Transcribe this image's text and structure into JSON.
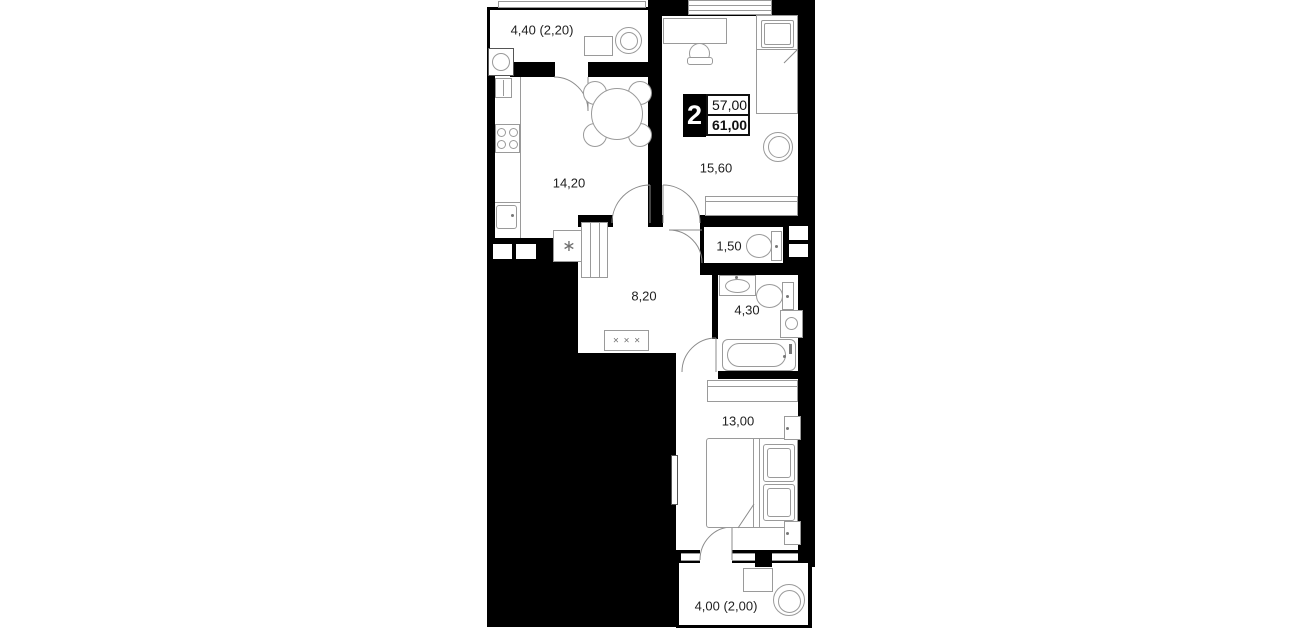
{
  "plan_title": "2-room apartment floor plan",
  "badge": {
    "rooms_count": "2",
    "area_top": "57,00",
    "area_bottom": "61,00"
  },
  "rooms": {
    "balcony_top": {
      "area_label": "4,40 (2,20)"
    },
    "kitchen": {
      "area_label": "14,20"
    },
    "living_room": {
      "area_label": "15,60"
    },
    "wc": {
      "area_label": "1,50"
    },
    "hallway": {
      "area_label": "8,20"
    },
    "bathroom": {
      "area_label": "4,30"
    },
    "bedroom": {
      "area_label": "13,00"
    },
    "balcony_bottom": {
      "area_label": "4,00 (2,00)"
    }
  },
  "decor": {
    "coat_rack_symbol": "× × ×",
    "fridge_symbol": "∗"
  },
  "colors": {
    "wall": "#000000",
    "furniture_line": "#9a9a9a",
    "label_text": "#1f1f1f",
    "background": "#ffffff"
  }
}
